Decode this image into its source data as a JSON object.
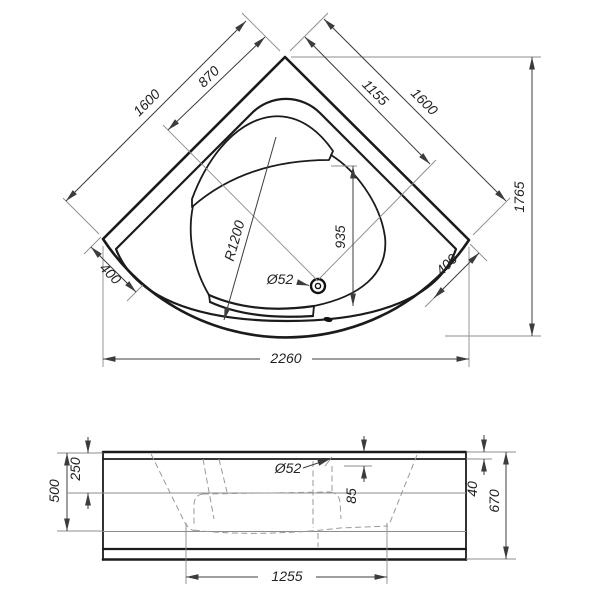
{
  "title": "Corner bathtub technical dimension drawing",
  "colors": {
    "line": "#1b1b1b",
    "dim": "#3c3c3c",
    "ext": "#8c8c8c",
    "dash": "#9a9a9a",
    "text": "#222222",
    "background": "#ffffff"
  },
  "plan_view": {
    "dims": {
      "left_edge_total": "1600",
      "left_edge_to_drain": "870",
      "right_edge_to_drain": "1155",
      "right_edge_total": "1600",
      "overall_depth": "1765",
      "left_corner_offset": "400",
      "right_corner_offset": "400",
      "overall_width": "2260",
      "drain_to_front": "935",
      "basin_radius": "R1200",
      "drain_diameter": "Ø52"
    }
  },
  "front_view": {
    "dims": {
      "inner_depth": "500",
      "rim_to_seat": "250",
      "overflow_diameter": "Ø52",
      "overflow_offset": "85",
      "rim_height": "40",
      "overall_height": "670",
      "base_length": "1255"
    }
  }
}
